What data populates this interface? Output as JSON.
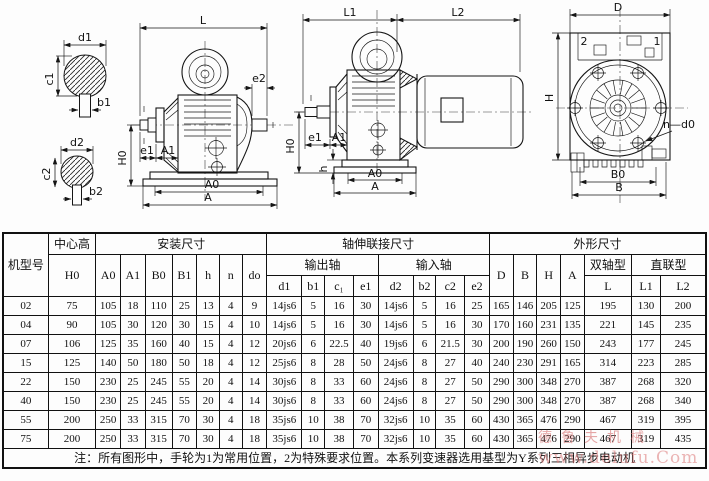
{
  "labels": {
    "L": "L",
    "L1": "L1",
    "L2": "L2",
    "H0": "H0",
    "A0": "A0",
    "A1": "A1",
    "A": "A",
    "B0": "B0",
    "B": "B",
    "D": "D",
    "H": "H",
    "h": "h",
    "n_d0": "n—d0",
    "e1": "e1",
    "e2": "e2",
    "d1": "d1",
    "b1": "b1",
    "c1": "c1",
    "d2": "d2",
    "b2": "b2",
    "c2": "c2",
    "pos1": "1",
    "pos2": "2"
  },
  "table": {
    "headers": {
      "model": "机型号",
      "center_height": "中心高",
      "h0": "H0",
      "install": "安装尺寸",
      "install_cols": [
        "A0",
        "A1",
        "B0",
        "B1",
        "h",
        "n",
        "do"
      ],
      "shaft": "轴伸联接尺寸",
      "output_shaft": "输出轴",
      "output_cols": [
        "d1",
        "b1",
        "c₁",
        "e1"
      ],
      "input_shaft": "输入轴",
      "input_cols": [
        "d2",
        "b2",
        "c2",
        "e2"
      ],
      "outline": "外形尺寸",
      "outline_cols": [
        "D",
        "B",
        "H",
        "A"
      ],
      "double_shaft": "双轴型",
      "double_col": "L",
      "direct": "直联型",
      "direct_cols": [
        "L1",
        "L2"
      ]
    },
    "rows": [
      [
        "02",
        "75",
        "105",
        "18",
        "110",
        "25",
        "13",
        "4",
        "9",
        "14js6",
        "5",
        "16",
        "30",
        "14js6",
        "5",
        "16",
        "25",
        "165",
        "146",
        "205",
        "125",
        "195",
        "130",
        "200"
      ],
      [
        "04",
        "90",
        "105",
        "30",
        "120",
        "30",
        "15",
        "4",
        "10",
        "14js6",
        "5",
        "16",
        "30",
        "14js6",
        "5",
        "16",
        "30",
        "170",
        "160",
        "231",
        "135",
        "221",
        "145",
        "235"
      ],
      [
        "07",
        "106",
        "125",
        "35",
        "160",
        "40",
        "15",
        "4",
        "12",
        "20js6",
        "6",
        "22.5",
        "40",
        "19js6",
        "6",
        "21.5",
        "30",
        "200",
        "190",
        "260",
        "150",
        "243",
        "177",
        "245"
      ],
      [
        "15",
        "125",
        "140",
        "50",
        "180",
        "50",
        "18",
        "4",
        "12",
        "25js6",
        "8",
        "28",
        "50",
        "24js6",
        "8",
        "27",
        "40",
        "240",
        "230",
        "291",
        "165",
        "314",
        "223",
        "285"
      ],
      [
        "22",
        "150",
        "230",
        "25",
        "245",
        "55",
        "20",
        "4",
        "14",
        "30js6",
        "8",
        "33",
        "60",
        "24js6",
        "8",
        "27",
        "50",
        "290",
        "300",
        "348",
        "270",
        "387",
        "268",
        "320"
      ],
      [
        "40",
        "150",
        "230",
        "25",
        "245",
        "55",
        "20",
        "4",
        "14",
        "30js6",
        "8",
        "33",
        "60",
        "24js6",
        "8",
        "27",
        "50",
        "290",
        "300",
        "348",
        "270",
        "387",
        "268",
        "340"
      ],
      [
        "55",
        "200",
        "250",
        "33",
        "315",
        "70",
        "30",
        "4",
        "18",
        "35js6",
        "10",
        "38",
        "70",
        "32js6",
        "10",
        "35",
        "60",
        "430",
        "365",
        "476",
        "290",
        "467",
        "319",
        "395"
      ],
      [
        "75",
        "200",
        "250",
        "33",
        "315",
        "70",
        "30",
        "4",
        "18",
        "35js6",
        "10",
        "38",
        "70",
        "32js6",
        "10",
        "35",
        "60",
        "430",
        "365",
        "476",
        "290",
        "467",
        "319",
        "435"
      ]
    ],
    "note": "注：所有图形中，手轮为1为常用位置，2为特殊要求位置。本系列变速器选用基型为Y系列三相异步电动机"
  },
  "watermark": {
    "line1": "德鲁夫机械",
    "line2": "www.delufu.Com",
    "color": "#d25f5f"
  }
}
